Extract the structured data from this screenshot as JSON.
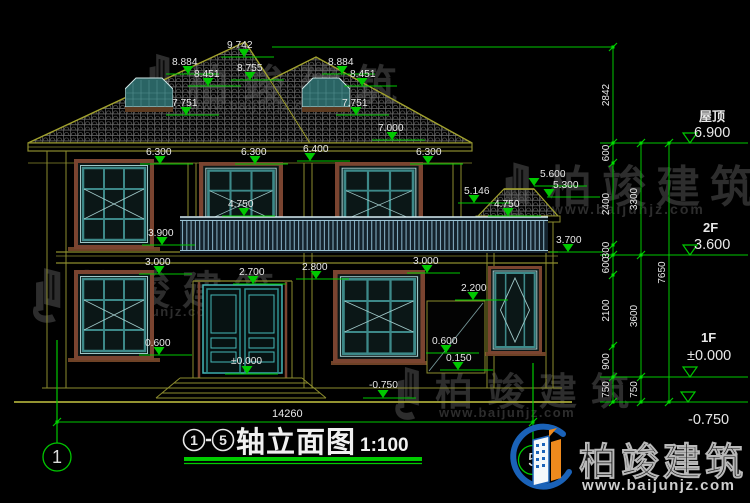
{
  "title": {
    "axis_from": "1",
    "axis_to": "5",
    "name": "轴立面图",
    "scale": "1:100"
  },
  "axes": {
    "left": "1",
    "right": "5"
  },
  "watermark": {
    "brand": "柏竣建筑",
    "url": "www.baijunjz.com"
  },
  "logo": {
    "brand": "柏竣建筑",
    "url": "www.baijunjz.com"
  },
  "colors": {
    "background": "#000000",
    "dimension_green": "#00c800",
    "wall_olive": "#8c8c2e",
    "text_white": "#e8e8e8",
    "window_teal": "#3d8989",
    "frame_brown": "#7a4430",
    "railing_blue": "#7fa8bc",
    "logo_blue": "#1a62b8",
    "logo_orange": "#ef8a1d",
    "watermark_gray": "#2d2d2d"
  },
  "annotations": {
    "elevation_marks": [
      {
        "t": "9.742",
        "tx": 227,
        "ty": 48,
        "ax": 244,
        "y": 57
      },
      {
        "t": "8.884",
        "tx": 172,
        "ty": 65,
        "ax": 188,
        "y": 74
      },
      {
        "t": "8.451",
        "tx": 194,
        "ty": 77,
        "ax": 208,
        "y": 86
      },
      {
        "t": "7.751",
        "tx": 172,
        "ty": 106,
        "ax": 186,
        "y": 115
      },
      {
        "t": "8.755",
        "tx": 237,
        "ty": 71,
        "ax": 250,
        "y": 80
      },
      {
        "t": "8.884",
        "tx": 328,
        "ty": 65,
        "ax": 342,
        "y": 74
      },
      {
        "t": "8.451",
        "tx": 350,
        "ty": 77,
        "ax": 362,
        "y": 86
      },
      {
        "t": "7.751",
        "tx": 342,
        "ty": 106,
        "ax": 356,
        "y": 115
      },
      {
        "t": "7.000",
        "tx": 378,
        "ty": 131,
        "ax": 392,
        "y": 140
      },
      {
        "t": "6.300",
        "tx": 146,
        "ty": 155,
        "ax": 160,
        "y": 164
      },
      {
        "t": "6.300",
        "tx": 241,
        "ty": 155,
        "ax": 255,
        "y": 164
      },
      {
        "t": "6.400",
        "tx": 303,
        "ty": 152,
        "ax": 310,
        "y": 161
      },
      {
        "t": "6.300",
        "tx": 416,
        "ty": 155,
        "ax": 428,
        "y": 164
      },
      {
        "t": "5.600",
        "tx": 540,
        "ty": 177,
        "ax": 534,
        "y": 186
      },
      {
        "t": "5.300",
        "tx": 553,
        "ty": 188,
        "ax": 549,
        "y": 197
      },
      {
        "t": "5.146",
        "tx": 464,
        "ty": 194,
        "ax": 474,
        "y": 203
      },
      {
        "t": "4.750",
        "tx": 228,
        "ty": 207,
        "ax": 244,
        "y": 216
      },
      {
        "t": "4.750",
        "tx": 494,
        "ty": 207,
        "ax": 508,
        "y": 216
      },
      {
        "t": "3.900",
        "tx": 148,
        "ty": 236,
        "ax": 162,
        "y": 245
      },
      {
        "t": "3.700",
        "tx": 556,
        "ty": 243,
        "ax": 568,
        "y": 252
      },
      {
        "t": "3.000",
        "tx": 145,
        "ty": 265,
        "ax": 159,
        "y": 274
      },
      {
        "t": "3.000",
        "tx": 413,
        "ty": 264,
        "ax": 427,
        "y": 273
      },
      {
        "t": "2.800",
        "tx": 302,
        "ty": 270,
        "ax": 316,
        "y": 279
      },
      {
        "t": "2.700",
        "tx": 239,
        "ty": 275,
        "ax": 253,
        "y": 284
      },
      {
        "t": "2.200",
        "tx": 461,
        "ty": 291,
        "ax": 473,
        "y": 300
      },
      {
        "t": "0.600",
        "tx": 145,
        "ty": 346,
        "ax": 159,
        "y": 355
      },
      {
        "t": "0.600",
        "tx": 432,
        "ty": 344,
        "ax": 446,
        "y": 353
      },
      {
        "t": "0.150",
        "tx": 446,
        "ty": 361,
        "ax": 458,
        "y": 370
      },
      {
        "t": "±0.000",
        "tx": 231,
        "ty": 364,
        "ax": 247,
        "y": 374
      },
      {
        "t": "-0.750",
        "tx": 369,
        "ty": 388,
        "ax": 383,
        "y": 398
      }
    ],
    "right_levels": [
      {
        "name": "屋顶",
        "value": "6.900",
        "y": 143,
        "tri": 690,
        "nx": 699,
        "ny": 121,
        "vx": 694,
        "vy": 137
      },
      {
        "name": "2F",
        "value": "3.600",
        "y": 255,
        "tri": 690,
        "nx": 703,
        "ny": 232,
        "vx": 694,
        "vy": 249
      },
      {
        "name": "1F",
        "value": "±0.000",
        "y": 377,
        "tri": 690,
        "nx": 701,
        "ny": 342,
        "vx": 687,
        "vy": 360
      },
      {
        "name": "",
        "value": "-0.750",
        "y": 402,
        "tri": 688,
        "nx": 0,
        "ny": 0,
        "vx": 688,
        "vy": 424
      }
    ],
    "dim_chains": [
      {
        "x": 613,
        "bounds": [
          47,
          143,
          163,
          245,
          255,
          275,
          346,
          377,
          402
        ],
        "labels": [
          "2842",
          "600",
          "2400",
          "300",
          "600",
          "2100",
          "900",
          "750"
        ]
      },
      {
        "x": 641,
        "bounds": [
          143,
          255,
          377,
          402
        ],
        "labels": [
          "3300",
          "3600",
          "750"
        ]
      },
      {
        "x": 669,
        "bounds": [
          143,
          402
        ],
        "labels": [
          "7650"
        ]
      }
    ],
    "total_width": {
      "value": "14260",
      "x1": 57,
      "x2": 533,
      "y": 422,
      "tx": 272,
      "ty": 417
    },
    "extra_lines": [
      [
        272,
        47,
        613,
        47
      ]
    ],
    "axis_lines": [
      [
        57,
        340,
        57,
        443
      ],
      [
        533,
        363,
        533,
        445
      ]
    ]
  }
}
